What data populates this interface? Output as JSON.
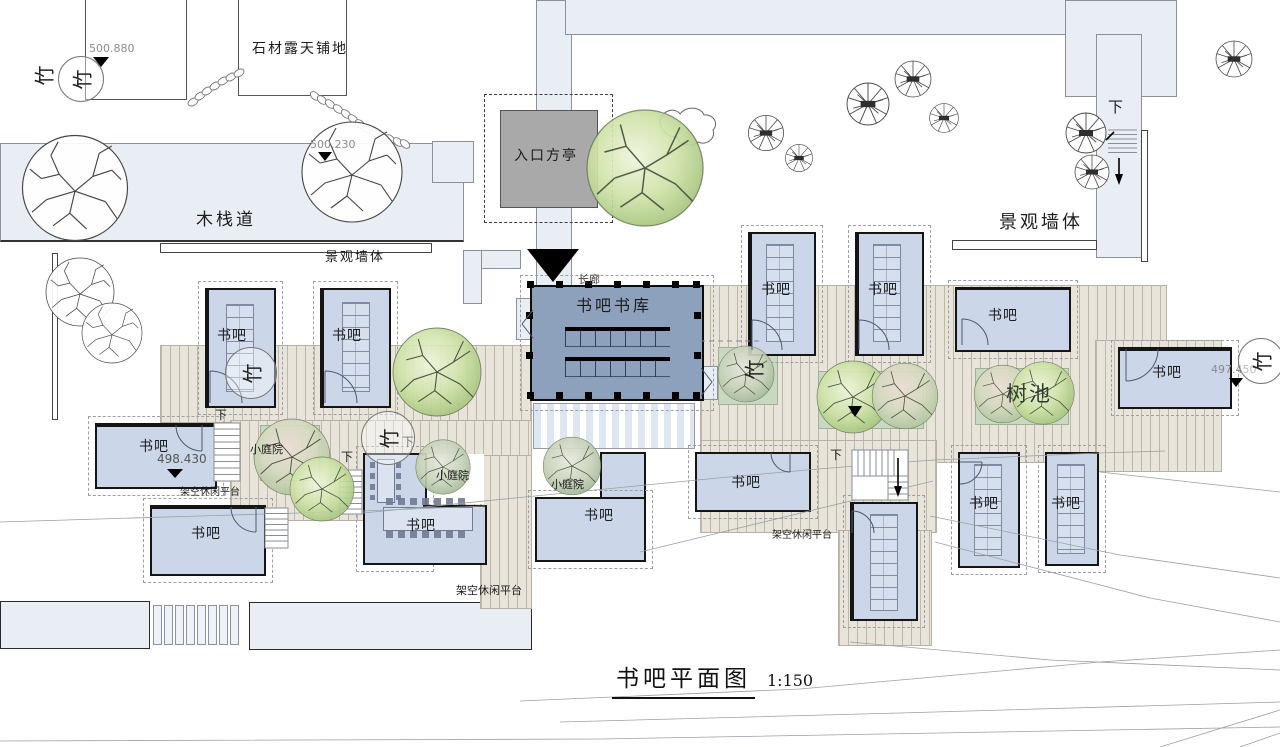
{
  "drawing": {
    "title": "书吧平面图",
    "scale": "1:150"
  },
  "site": {
    "boardwalk": "木栈道",
    "stone_paving": "石材露天铺地",
    "entry_pavilion": "入口方亭",
    "long_corridor": "长廊",
    "landscape_wall": "景观墙体",
    "tree_pool": "树池",
    "elevated_platform": "架空休闲平台",
    "small_courtyard": "小庭院",
    "down": "下",
    "bamboo_mark": "竹"
  },
  "rooms": {
    "book_bar": "书吧",
    "book_store": "书吧书库",
    "book_bar_count": 13
  },
  "elevations": {
    "stone_paving_area": "500.880",
    "boardwalk_area": "500.230",
    "west_platform": "498.430",
    "east_platform": "497.450"
  },
  "colors": {
    "room_fill": "#cbd7e8",
    "bookstore_fill": "#8da1bc",
    "path_fill": "#e9eef5",
    "deck_fill": "#e8e4da",
    "planter_fill": "#c9d8c0",
    "pavilion_fill": "#a9a9a9",
    "wall_black": "#151515"
  }
}
